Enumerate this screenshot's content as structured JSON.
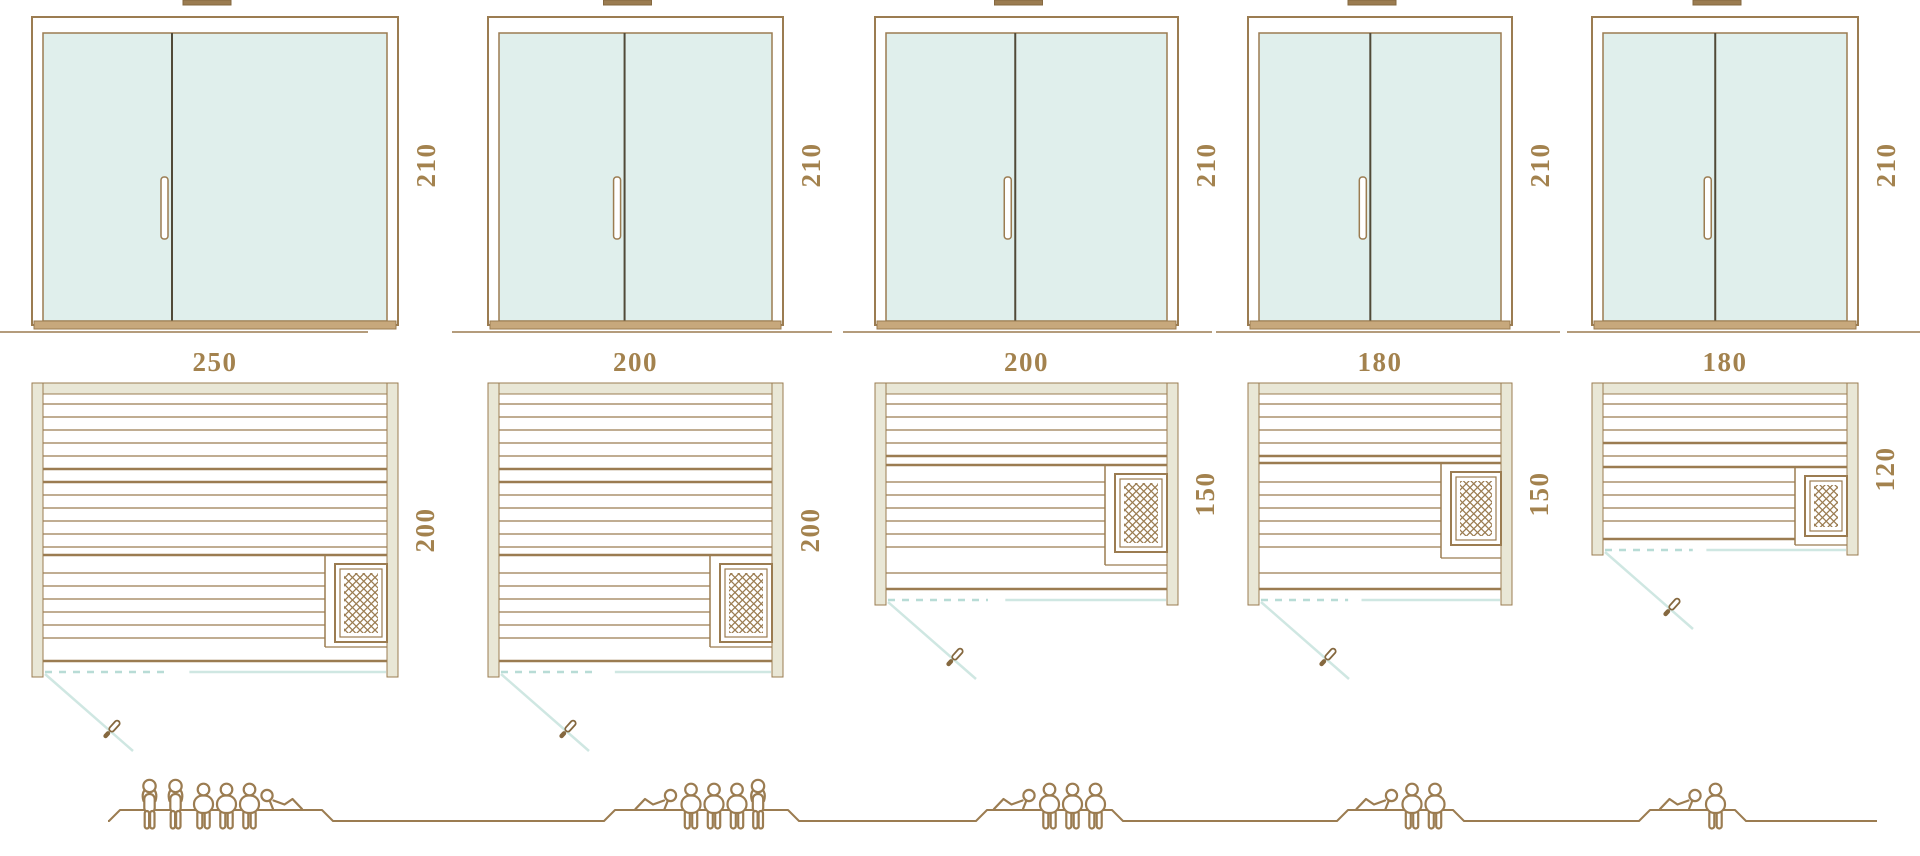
{
  "diagram": {
    "units": [
      {
        "id": "sauna-250x200",
        "elevation": {
          "height_label": "210"
        },
        "plan": {
          "width_label": "250",
          "depth_label": "200"
        },
        "capacity": {
          "people_total": 6,
          "figures": [
            "standing",
            "standing",
            "sitting",
            "sitting",
            "sitting",
            "lying"
          ]
        }
      },
      {
        "id": "sauna-200x200",
        "elevation": {
          "height_label": "210"
        },
        "plan": {
          "width_label": "200",
          "depth_label": "200"
        },
        "capacity": {
          "people_total": 5,
          "figures": [
            "lying",
            "sitting",
            "sitting",
            "sitting",
            "standing"
          ]
        }
      },
      {
        "id": "sauna-200x150",
        "elevation": {
          "height_label": "210"
        },
        "plan": {
          "width_label": "200",
          "depth_label": "150"
        },
        "capacity": {
          "people_total": 4,
          "figures": [
            "lying",
            "sitting",
            "sitting",
            "sitting"
          ]
        }
      },
      {
        "id": "sauna-180x150",
        "elevation": {
          "height_label": "210"
        },
        "plan": {
          "width_label": "180",
          "depth_label": "150"
        },
        "capacity": {
          "people_total": 3,
          "figures": [
            "lying",
            "sitting",
            "sitting"
          ]
        }
      },
      {
        "id": "sauna-180x120",
        "elevation": {
          "height_label": "210"
        },
        "plan": {
          "width_label": "180",
          "depth_label": "120"
        },
        "capacity": {
          "people_total": 2,
          "figures": [
            "lying",
            "sitting"
          ]
        }
      }
    ],
    "colors": {
      "line_brown": "#9b7c51",
      "divider_dark": "#514a38",
      "dimension_text": "#a3824e",
      "glass_fill": "#e0efec",
      "wall_fill": "#e9e7d6",
      "sill_fill": "#c7a87c",
      "door_swing_teal": "#cfe7e2",
      "door_dash_teal": "#b8dcd6",
      "handle_dark": "#85683f",
      "white": "#ffffff"
    }
  }
}
